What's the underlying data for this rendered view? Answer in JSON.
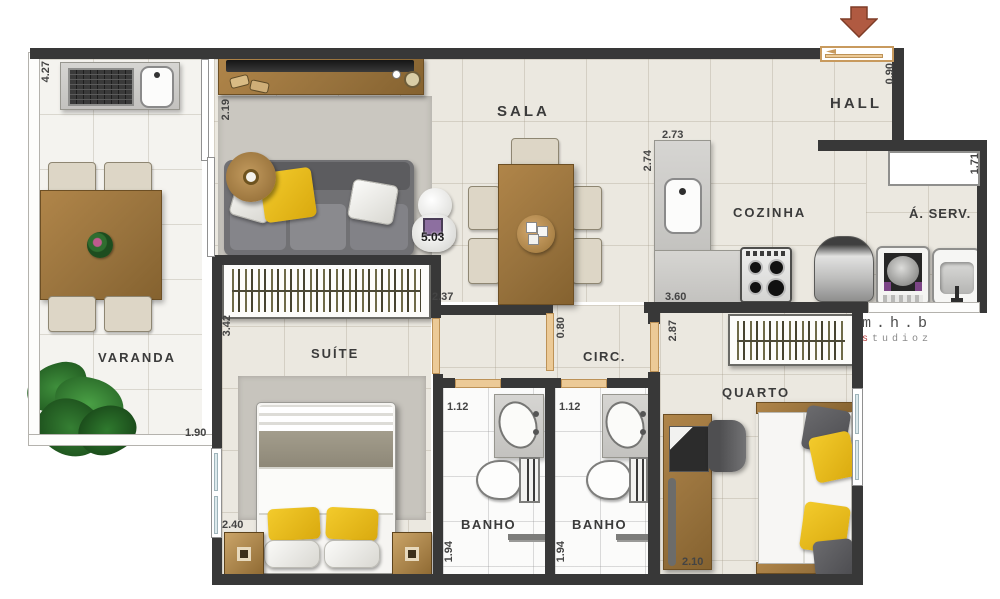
{
  "plan": {
    "rooms": {
      "varanda": "VARANDA",
      "sala": "SALA",
      "hall": "HALL",
      "cozinha": "COZINHA",
      "aserv": "Á. SERV.",
      "suite": "SUÍTE",
      "circ": "CIRC.",
      "banho1": "BANHO",
      "banho2": "BANHO",
      "quarto": "QUARTO"
    },
    "dims": {
      "varanda_height": "4.27",
      "varanda_width": "1.90",
      "sala_left": "2.19",
      "sala_width": "2.37",
      "sala_area": "5.03",
      "circ_door": "0.80",
      "entry_door": "0.90",
      "cozinha_top": "2.73",
      "cozinha_left": "2.74",
      "cozinha_width": "3.60",
      "aserv_window": "1.71",
      "quarto_door": "2.87",
      "suite_left": "3.42",
      "suite_width": "2.40",
      "banho1_width": "1.12",
      "banho2_width": "1.12",
      "banho1_depth": "1.94",
      "banho2_depth": "1.94",
      "quarto_width": "2.10"
    },
    "watermark": {
      "line1": "m.h.b",
      "line2": "studioz"
    },
    "colors": {
      "wall": "#383838",
      "door": "#ecca97",
      "entry_arrow": "#b05a41",
      "pillow_yellow": "#e8bc1c"
    }
  }
}
